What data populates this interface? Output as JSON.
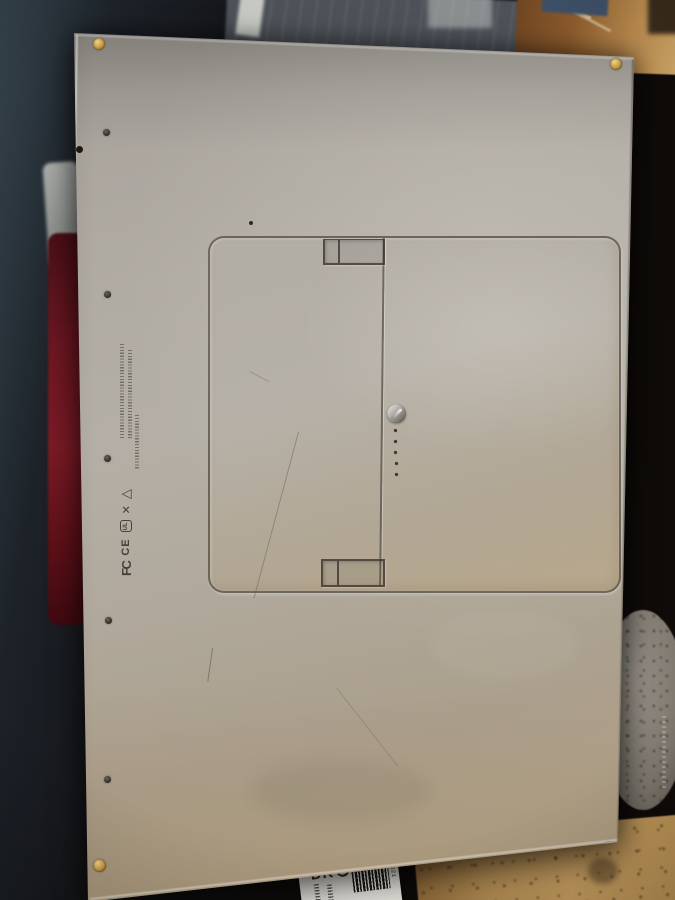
{
  "scene": {
    "title": "Bottom of a silver aluminum laptop",
    "setting": "Laptop upside down on a cardboard box surrounded by dark packing material, red item at left, gray stone at lower right"
  },
  "laptop": {
    "finish_color": "#b0aba3",
    "battery_door": {
      "led_count": 5
    },
    "vents": {
      "top_count": 20,
      "bottom_count": 18
    },
    "regulatory": {
      "fcc_mark": "FC",
      "ce_mark": "CE",
      "ul_mark": "UL",
      "weee_mark": "✕",
      "recycle_mark": "△"
    },
    "screw_colors": {
      "corner": "#c49a42",
      "inner": "#2c2720"
    }
  },
  "sticker": {
    "large_text": "DK",
    "barcode_digits": "400521"
  },
  "colors": {
    "background_dark": "#12100e",
    "background_navy": "#2e3a43",
    "cardboard_tan": "#b98e54",
    "red_object": "#6e1722",
    "stone_gray": "#8d8880",
    "sticker_white": "#ece9e3"
  }
}
